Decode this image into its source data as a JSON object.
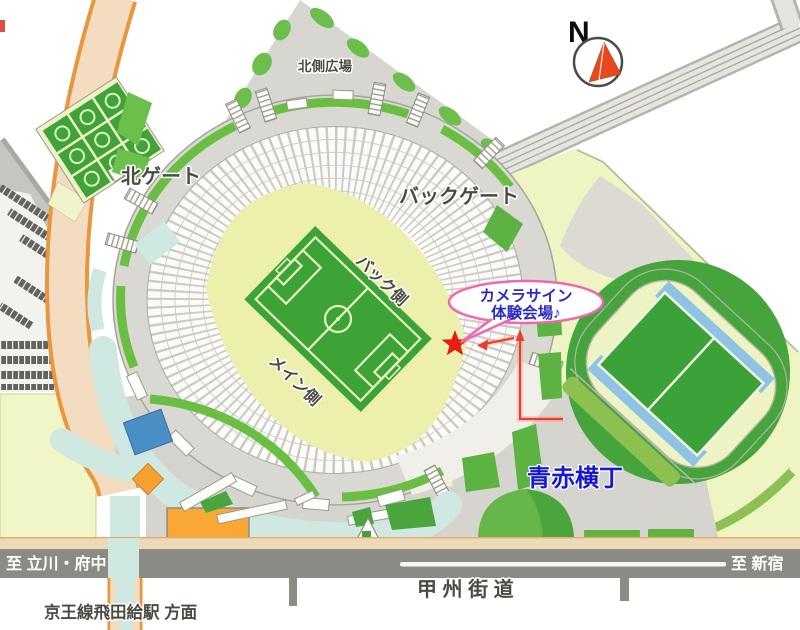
{
  "map": {
    "labels": {
      "north_plaza": "北側広場",
      "north_gate": "北ゲート",
      "back_gate": "バックゲート",
      "back_side": "バック側",
      "main_side": "メイン側",
      "aoaka_yokocho": "青赤横丁",
      "koshu_kaido": "甲 州 街 道",
      "to_shinjuku": "至 新宿",
      "to_tachikawa_fuchu": "至 立川・府中",
      "keio_line": "京王線飛田給駅 方面",
      "compass_n": "N"
    },
    "callout": {
      "line1": "カメラサイン",
      "line2": "体験会場♪"
    },
    "colors": {
      "callout_border": "#f266ae",
      "callout_text": "#2b2bc8",
      "aoaka_text": "#1616d6",
      "route_red": "#e8402c",
      "star_red": "#ee1c0c",
      "pitch_green": "#3da336",
      "field_pale": "#edf0ad",
      "park_pale": "#eef5c2",
      "walkway_cyan": "#cfe9e2",
      "ring_gray": "#dad8d2",
      "road_dark": "#8b8b86",
      "road_tan": "#ecd9b8",
      "accent_orange": "#f9a836",
      "track_blue": "#8fc3e4",
      "map_green": "#5db342"
    }
  }
}
